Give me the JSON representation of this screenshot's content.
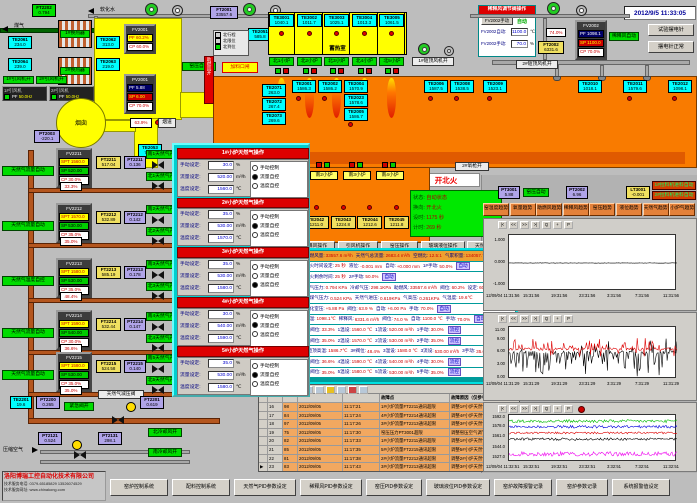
{
  "datetime": "2012/9/5 11:33:05",
  "company": {
    "name": "洛阳博瑞工控自动化技术有限公司",
    "phone": "技术服务电话: 0379-65185829  13526074529",
    "web": "技术服务网址: www.chinakong.com"
  },
  "top_left": {
    "coal_gas_label": "煤气",
    "soft_water_label": "软化水",
    "ft2202": {
      "tag": "FT2202",
      "value": "0.794"
    },
    "exchangers": [
      "1#换热器",
      "2#换热器"
    ],
    "te_boxes": [
      {
        "tag": "TE2061",
        "value": "234.0"
      },
      {
        "tag": "TE2062",
        "value": "313.0"
      },
      {
        "tag": "TE2064",
        "value": "239.0"
      },
      {
        "tag": "TE2063",
        "value": "219.0"
      }
    ],
    "fan_status": [
      "1#引风机开",
      "2#引风机开"
    ],
    "fan_panels": [
      {
        "label": "1#引风机",
        "pf": "PF",
        "value": "50.0Hz"
      },
      {
        "label": "2#引风机",
        "pf": "PF",
        "value": "50.0Hz"
      }
    ],
    "chimney_label": "烟囱",
    "fv2001": {
      "tag": "FV2001",
      "pf": "60.2%",
      "cp": "60.0%"
    },
    "pv2001": {
      "tag": "PV2001",
      "pf": "5.88",
      "sp": "6.00",
      "cp": "70.0%"
    },
    "kiln_pressure_auto": "窑压自动",
    "damper_value": "63.9%",
    "flue_label": "烟道",
    "te2053": {
      "tag": "TE2053",
      "value": "745.7"
    },
    "pt2003": {
      "tag": "PT2003",
      "value": "-220.1"
    },
    "te2051": {
      "tag": "TE2051",
      "value": "585.8"
    },
    "ft2001": {
      "tag": "FT2001",
      "value": "33557.6"
    },
    "combustion_fan_on": "助燃风开",
    "feeder_label": "加料口闸",
    "reversal_legend": [
      {
        "label": "北行程",
        "on": false
      },
      {
        "label": "北限位",
        "on": false
      },
      {
        "label": "北到位",
        "on": true
      }
    ]
  },
  "regenerator": {
    "label": "蓄热室",
    "cells": [
      {
        "tag": "TE3001",
        "value": "1040.1"
      },
      {
        "tag": "TE3002",
        "value": "1011.7"
      },
      {
        "tag": "TE3003",
        "value": "1025.1"
      },
      {
        "tag": "TE3004",
        "value": "1013.3"
      },
      {
        "tag": "TE3005",
        "value": "1061.5"
      }
    ]
  },
  "north_burners": [
    "北1小炉",
    "北2小炉",
    "北3小炉",
    "北4小炉",
    "北5小炉"
  ],
  "south_burners": {
    "chips": [
      "南1小炉",
      "南2小炉",
      "南3小炉",
      "南4小炉"
    ],
    "te": [
      {
        "tag": "TE2041",
        "value": "1209.6"
      },
      {
        "tag": "TE2042",
        "value": "1211.0"
      },
      {
        "tag": "TE2043",
        "value": "1224.8"
      },
      {
        "tag": "TE2044",
        "value": "1212.6"
      },
      {
        "tag": "TE2045",
        "value": "1211.8"
      }
    ]
  },
  "furnace": {
    "left_te": [
      {
        "tag": "TE2071",
        "value": "263.0"
      },
      {
        "tag": "TE2072",
        "value": "267.4"
      },
      {
        "tag": "TE2073",
        "value": "269.6"
      }
    ],
    "crown_te": [
      {
        "tag": "TE2001",
        "value": "1586.3"
      },
      {
        "tag": "TE2002",
        "value": "1586.2"
      },
      {
        "tag": "TE2004",
        "value": "1570.9"
      },
      {
        "tag": "TE2023",
        "value": "1578.6"
      },
      {
        "tag": "TE2005",
        "value": "1586.7"
      },
      {
        "tag": "TE2006",
        "value": "1587.5"
      },
      {
        "tag": "TE2008",
        "value": "1538.5"
      }
    ],
    "right_te": [
      {
        "tag": "TE2009",
        "value": "1523.1"
      },
      {
        "tag": "TE2010",
        "value": "1018.1"
      },
      {
        "tag": "TE2011",
        "value": "1579.6"
      },
      {
        "tag": "TE2012",
        "value": "1098.1"
      }
    ]
  },
  "top_right": {
    "dilution_panel": {
      "title": "稀释风调节阀操作",
      "manual_btn": "FV2002手动",
      "auto_label": "自动",
      "auto_row": {
        "label": "FV2002自动:",
        "value": "1100.0",
        "unit": "℃"
      },
      "manual_row": {
        "label": "FV2002手动:",
        "value": "70.0",
        "unit": "%"
      }
    },
    "fv2002": {
      "tag": "FV2002",
      "pf": "1098.1",
      "sp": "1100.0",
      "cp": "70.0%"
    },
    "dilution_auto": "稀释风自动",
    "valve_pct": "74.0%",
    "ft2002": {
      "tag": "FT2002",
      "value": "6331.6"
    },
    "crown_fan1": "1#碹顶风机开",
    "crown_fan2": "2#碹顶风机开",
    "btn_test": "试验摆电针",
    "btn_normal": "摆电针正常"
  },
  "fire_status": {
    "banner": "开北火",
    "oxygen_chip": "2#氧枪开",
    "lines": [
      {
        "label": "状态:",
        "value": "自动状态"
      },
      {
        "label": "换向:",
        "value": "开北火"
      },
      {
        "label": "设时:",
        "value": "1175 秒"
      },
      {
        "label": "计时:",
        "value": "269 秒"
      }
    ]
  },
  "misc_boxes": [
    {
      "tag": "PT3001",
      "value": "5.88",
      "type": "purpleb"
    },
    {
      "tag": "PT2002",
      "value": "6.96",
      "type": "purpleb"
    },
    {
      "tag": "LT3001",
      "value": "-0.001",
      "type": "yellowb2"
    }
  ],
  "kiln_pressure_auto2": "窑压自动",
  "puller_chips": [
    "1#拉料机进料自动",
    "2#拉料机进料自动"
  ],
  "op_buttons": [
    "助燃风操作",
    "稀释风操作",
    "引风机操作",
    "窑压操作",
    "玻璃液位操作",
    "天然气操作"
  ],
  "trend_buttons": [
    "窑温度趋势",
    "氧量趋势",
    "助燃风趋势",
    "稀释风趋势",
    "窑压趋势",
    "液位趋势",
    "天然气趋势",
    "小炉气趋势"
  ],
  "popup": {
    "options": [
      "手动控制",
      "流量自控",
      "温度自控"
    ],
    "labels": {
      "manual": "手动设定:",
      "flow": "流量设定:",
      "temp": "温度设定:",
      "manual_unit": "%",
      "flow_unit": "m³/h",
      "temp_unit": "℃"
    },
    "panels": [
      {
        "title": "1#小炉天然气操作",
        "manual": "30.0",
        "flow": "520.00",
        "temp": "1560.0",
        "mode": 1
      },
      {
        "title": "2#小炉天然气操作",
        "manual": "35.0",
        "flow": "530.00",
        "temp": "1570.0",
        "mode": 1
      },
      {
        "title": "3#小炉天然气操作",
        "manual": "35.0",
        "flow": "530.00",
        "temp": "1580.0",
        "mode": 2
      },
      {
        "title": "4#小炉天然气操作",
        "manual": "30.0",
        "flow": "540.00",
        "temp": "1590.0",
        "mode": 1
      },
      {
        "title": "5#小炉天然气操作",
        "manual": "35.0",
        "flow": "530.00",
        "temp": "1580.0",
        "mode": 1
      }
    ]
  },
  "data_panel": {
    "rows": [
      {
        "hdr": true,
        "seg": [
          [
            "助燃风量:",
            "33557.6 m³/h"
          ],
          [
            "天然气总流量:",
            "2683.4 m³/h"
          ],
          [
            "空燃比:",
            "12.5:1"
          ],
          [
            "气累积量:",
            "134057.7m³"
          ]
        ]
      },
      {
        "seg": [
          [
            "换火时间设定:",
            "25 秒"
          ],
          [
            "液位:",
            "-0.001 mm"
          ],
          [
            "自动:",
            "+0.000 mm"
          ],
          [
            "1#手动:",
            "50.0%"
          ],
          [
            "",
            "自动"
          ]
        ]
      },
      {
        "seg": [
          [
            "换火剩余时间:",
            "25 秒"
          ],
          [
            "2#手动:",
            "50.0%"
          ],
          [
            "",
            "自动"
          ]
        ]
      },
      {
        "seg": [
          [
            "煤气压力:",
            "0.794 KPa"
          ],
          [
            "冷却气压:",
            "298.1KPa"
          ],
          [
            "助燃风:",
            "33557.6 m³/h"
          ],
          [
            "阀位:",
            "60.2%"
          ],
          [
            "设定:",
            "60.0%"
          ]
        ]
      },
      {
        "seg": [
          [
            "炉煤气压力:",
            "0.524 KPa"
          ],
          [
            "天然气进压:",
            "0.619KPa"
          ],
          [
            "气高压:",
            "0.261KPa"
          ],
          [
            "气温度:",
            "19.6℃"
          ]
        ]
      },
      {
        "seg": [
          [
            "熔化室压:",
            "+5.88 Pa"
          ],
          [
            "阀位:",
            "63.9 %"
          ],
          [
            "自动:",
            "+6.00 Pa"
          ],
          [
            "手动:",
            "70.0%"
          ],
          [
            "",
            "自动"
          ]
        ]
      },
      {
        "seg": [
          [
            "烟温:",
            "1098.1℃"
          ],
          [
            "稀释风:",
            "6331.6 m³/h"
          ],
          [
            "阀位:",
            "74.0 %"
          ],
          [
            "自动:",
            "1100.0 ℃"
          ],
          [
            "手动:",
            "70.0%"
          ],
          [
            "",
            "自动"
          ]
        ]
      },
      {
        "seg": [
          [
            "1#阀位:",
            "33.3%"
          ],
          [
            "1温设:",
            "1560.0 ℃"
          ],
          [
            "1流设:",
            "520.00 m³/h"
          ],
          [
            "1手动:",
            "30.0%"
          ],
          [
            "",
            "流控"
          ]
        ]
      },
      {
        "seg": [
          [
            "2#阀位:",
            "35.0%"
          ],
          [
            "2温设:",
            "1570.0 ℃"
          ],
          [
            "2流设:",
            "530.00 m³/h"
          ],
          [
            "2手动:",
            "35.0%"
          ],
          [
            "",
            "流控"
          ]
        ]
      },
      {
        "seg": [
          [
            "3碹顶高温:",
            "1586.7℃"
          ],
          [
            "3#阀位:",
            "48.4%"
          ],
          [
            "3温设:",
            "1580.0 ℃"
          ],
          [
            "3流设:",
            "530.00 m³/h"
          ],
          [
            "3手动:",
            "35.0%"
          ],
          [
            "",
            "温控"
          ]
        ]
      },
      {
        "seg": [
          [
            "4#阀位:",
            "36.6%"
          ],
          [
            "4温设:",
            "1590.0 ℃"
          ],
          [
            "4流设:",
            "540.00 m³/h"
          ],
          [
            "4手动:",
            "30.0%"
          ],
          [
            "",
            "流控"
          ]
        ]
      },
      {
        "seg": [
          [
            "5#阀位:",
            "35.0%"
          ],
          [
            "5温设:",
            "1580.0 ℃"
          ],
          [
            "5流设:",
            "530.00 m³/h"
          ],
          [
            "5手动:",
            "35.0%"
          ],
          [
            "",
            "流控"
          ]
        ]
      }
    ]
  },
  "gas_loops": [
    {
      "mode": "天然气流量自动",
      "fv": "FV2211",
      "spt": "1560.0",
      "sp": "520.00",
      "cp": "30.0%",
      "ft": "FT2211",
      "flow": "517.04",
      "pt": "PT2211",
      "press": "0.136",
      "valve": "33.3%",
      "south": "南1天然气开",
      "north": "北1天然气开"
    },
    {
      "mode": "天然气流量自动",
      "fv": "FV2212",
      "spt": "1570.0",
      "sp": "530.00",
      "cp": "35.0%",
      "ft": "FT2212",
      "flow": "532.89",
      "pt": "PT2212",
      "press": "0.142",
      "valve": "35.0%",
      "south": "南2天然气开",
      "north": "北2天然气开"
    },
    {
      "mode": "天然气温度自控",
      "fv": "FV2213",
      "spt": "1580.0",
      "sp": "530.00",
      "cp": "35.0%",
      "ft": "FT2213",
      "flow": "585.19",
      "pt": "PT2213",
      "press": "0.178",
      "valve": "48.4%",
      "south": "南3天然气开",
      "north": "北3天然气开"
    },
    {
      "mode": "天然气流量自动",
      "fv": "FV2214",
      "spt": "1590.0",
      "sp": "540.00",
      "cp": "30.0%",
      "ft": "FT2214",
      "flow": "532.44",
      "pt": "PT2214",
      "press": "0.147",
      "valve": "36.6%",
      "south": "南4天然气开",
      "north": "北4天然气开"
    },
    {
      "mode": "天然气流量自动",
      "fv": "FV2215",
      "spt": "1580.0",
      "sp": "530.00",
      "cp": "35.0%",
      "ft": "FT2215",
      "flow": "524.58",
      "pt": "PT2215",
      "press": "0.140",
      "valve": "35.0%",
      "south": "南5天然气开",
      "north": "北5天然气开"
    }
  ],
  "gas_main": {
    "te": {
      "tag": "TE2201",
      "value": "19.6"
    },
    "pt": {
      "tag": "PT2200",
      "value": "0.265"
    },
    "valve_open": "紧急阀开",
    "regulator": "天然气减压阀",
    "ft": {
      "tag": "FT2201",
      "value": "0.619"
    }
  },
  "compressed_air": {
    "label": "压缩空气",
    "pt1": {
      "tag": "PT2121",
      "value": "0.524"
    },
    "pt2": {
      "tag": "PT2131",
      "value": "298.1"
    },
    "chips": [
      "北冷却风开",
      "南冷却风开"
    ]
  },
  "alarm_table": {
    "headers": {
      "point": "故障点",
      "reason": "故障原因（仅参考）"
    },
    "rows": [
      {
        "idx": "16",
        "code": "98",
        "date": "2012/09/05",
        "time": "11:17:21",
        "point": "1#小炉流量FT2211通讯超限",
        "reason": "调整1#小炉天然气调节阀或流量设定值"
      },
      {
        "idx": "17",
        "code": "84",
        "date": "2012/09/05",
        "time": "11:17:24",
        "point": "4#小炉流量FT2214通讯超限",
        "reason": "调整4#小炉天然气调节阀或流量设定值"
      },
      {
        "idx": "18",
        "code": "97",
        "date": "2012/09/05",
        "time": "11:17:26",
        "point": "3#小炉流量FT2213通讯超限",
        "reason": "调整3#小炉天然气调节阀或流量设定值"
      },
      {
        "idx": "19",
        "code": "75",
        "date": "2012/09/05",
        "time": "11:17:30",
        "point": "窑压压力PT3001超限",
        "reason": "调整窑压空气调节阀自动设定值"
      },
      {
        "idx": "20",
        "code": "82",
        "date": "2012/09/05",
        "time": "11:17:33",
        "point": "1#小炉流量FT2211通讯超限",
        "reason": "调整1#小炉天然气调节阀自动设定值"
      },
      {
        "idx": "21",
        "code": "85",
        "date": "2012/09/05",
        "time": "11:17:35",
        "point": "5#小炉流量FT2215通讯超限",
        "reason": "调整5#小炉天然气调节阀或流量设定值"
      },
      {
        "idx": "22",
        "code": "81",
        "date": "2012/09/05",
        "time": "11:17:38",
        "point": "2#小炉流量FT2212通讯超限",
        "reason": "调整2#小炉天然气调节阀或流量设定值"
      },
      {
        "idx": "23",
        "code": "83",
        "date": "2012/09/05",
        "time": "11:17:43",
        "point": "3#小炉流量FT2213通讯超限",
        "reason": "调整3#小炉天然气调节阀或流量设定值",
        "selected": true
      }
    ]
  },
  "bottom_buttons": [
    "窑炉控制系统",
    "配料控制系统",
    "天然气PID参数设定",
    "稀释风PID参数设定",
    "窑压PID参数设定",
    "玻璃液位PID参数设定",
    "窑炉故障报警记录",
    "窑炉参数记录",
    "系统报警值设定"
  ],
  "chart_data": [
    {
      "type": "line",
      "name": "液位趋势",
      "y_ticks": [
        "1.000",
        "0.000",
        "-1.000"
      ],
      "y_vals": [
        1,
        0,
        -1
      ],
      "ylim": [
        -1.25,
        1.25
      ],
      "x_ticks": [
        "12/09/04 11:31:56",
        "15:31:56",
        "19:31:56",
        "23:31:56",
        "3:31:56",
        "7:31:56",
        "11:31:56"
      ],
      "series": [
        {
          "name": "玻璃液位",
          "color": "#000000",
          "base": 0.0,
          "jitter": 0.01,
          "sdp": 0,
          "sd": 0,
          "sup": 0,
          "su": 0
        }
      ]
    },
    {
      "type": "line",
      "name": "窑压趋势",
      "y_ticks": [
        "11.00",
        "9.00",
        "6.00",
        "3.00",
        "0.00"
      ],
      "y_vals": [
        11,
        9,
        6,
        3,
        0
      ],
      "ylim": [
        -0.3,
        12
      ],
      "x_ticks": [
        "12/09/04 11:31:29",
        "15:31:29",
        "19:31:29",
        "23:31:29",
        "3:31:29",
        "7:31:29",
        "11:31:29"
      ],
      "series": [
        {
          "name": "窑压",
          "color": "#000000",
          "base": 6.0,
          "jitter": 0.35,
          "sdp": 0.38,
          "sd": 5.8,
          "sup": 0.1,
          "su": 3.2
        },
        {
          "name": "窑压设定",
          "color": "#dd0000",
          "base": 6.8,
          "jitter": 0.3,
          "sdp": 0.08,
          "sd": 2.0,
          "sup": 0.22,
          "su": 2.6
        }
      ]
    },
    {
      "type": "line",
      "name": "窑温趋势",
      "y_ticks": [
        "1592.0",
        "1578.0",
        "1561.0",
        "1544.0",
        "1527.0"
      ],
      "y_vals": [
        1592,
        1578,
        1561,
        1544,
        1527
      ],
      "ylim": [
        1521,
        1597
      ],
      "x_ticks": [
        "12/09/04 11:32:51",
        "15:32:51",
        "19:32:51",
        "23:32:51",
        "3:32:51",
        "7:32:51",
        "11:32:51"
      ],
      "series": [
        {
          "name": "1#炉温",
          "color": "#00bb00",
          "base": 1587,
          "jitter": 2.4,
          "sdp": 0,
          "sd": 0,
          "sup": 0,
          "su": 0
        },
        {
          "name": "2#炉温",
          "color": "#0000dd",
          "base": 1578,
          "jitter": 2.2,
          "sdp": 0,
          "sd": 0,
          "sup": 0,
          "su": 0
        },
        {
          "name": "3#炉温",
          "color": "#dd0000",
          "base": 1568,
          "jitter": 1.6,
          "sdp": 0,
          "sd": 0,
          "sup": 0,
          "su": 0
        },
        {
          "name": "4#炉温",
          "color": "#000000",
          "base": 1558,
          "jitter": 2.0,
          "sdp": 0,
          "sd": 0,
          "sup": 0,
          "su": 0
        },
        {
          "name": "5#炉温",
          "color": "#ee00ee",
          "base": 1534,
          "jitter": 3.5,
          "sdp": 0,
          "sd": 0,
          "sup": 0,
          "su": 0
        }
      ]
    }
  ]
}
